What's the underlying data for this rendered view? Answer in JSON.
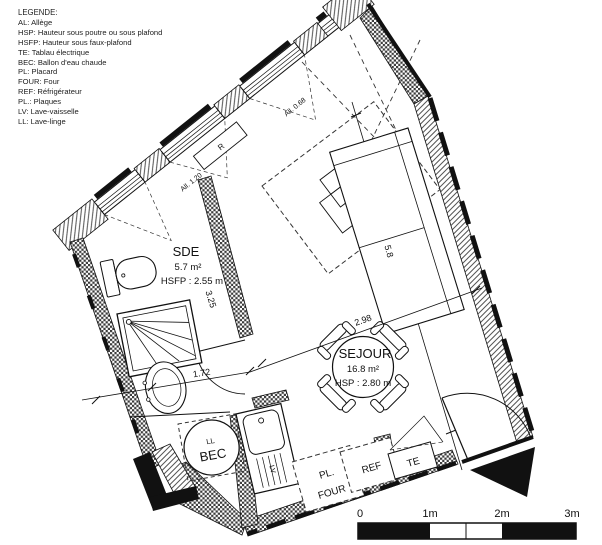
{
  "legend": {
    "title": "LEGENDE:",
    "items": [
      "AL: Allège",
      "HSP: Hauteur sous poutre ou sous plafond",
      "HSFP: Hauteur sous faux-plafond",
      "TE: Tablau électrique",
      "BEC: Ballon d'eau chaude",
      "PL: Placard",
      "FOUR: Four",
      "REF: Réfrigérateur",
      "PL.: Plaques",
      "LV: Lave-vaisselle",
      "LL: Lave-linge"
    ]
  },
  "rooms": {
    "sde": {
      "name": "SDE",
      "area": "5.7 m²",
      "height": "HSFP : 2.55 m"
    },
    "sejour": {
      "name": "SEJOUR",
      "area": "16.8 m²",
      "height": "HSP : 2.80 m"
    }
  },
  "labels": {
    "allege_sde": "All. 1.20",
    "allege_sejour": "All. 0.68",
    "radiator": "R",
    "washer": "LL",
    "water_heater": "BEC",
    "dishwasher": "LV",
    "hotplates": "PL.",
    "oven": "FOUR",
    "fridge": "REF",
    "electrical_panel": "TE"
  },
  "dimensions": {
    "sde_depth": "3.25",
    "sde_width": "1.72",
    "sejour_width": "2.98",
    "sejour_length": "5.8"
  },
  "scale_bar": {
    "labels": [
      "0",
      "1m",
      "2m",
      "3m"
    ]
  },
  "colors": {
    "ink": "#111111",
    "paper": "#ffffff"
  }
}
